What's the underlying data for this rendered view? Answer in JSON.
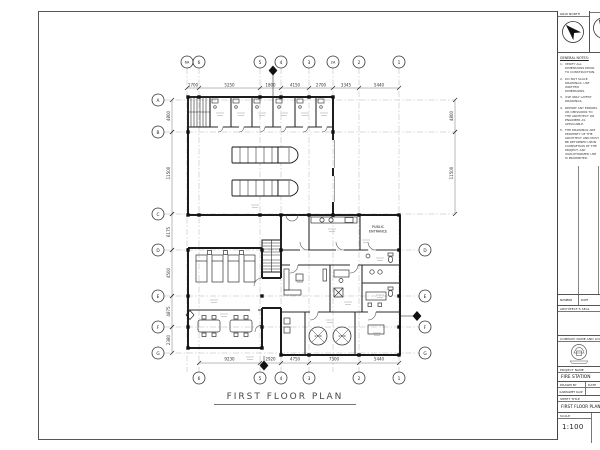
{
  "drawing": {
    "title": "FIRST FLOOR PLAN"
  },
  "plan": {
    "bubbles_top": [
      {
        "t": "6A",
        "x": 187
      },
      {
        "t": "6",
        "x": 199
      },
      {
        "t": "5",
        "x": 260
      },
      {
        "t": "4",
        "x": 281
      },
      {
        "t": "3",
        "x": 309
      },
      {
        "t": "2A",
        "x": 333
      },
      {
        "t": "2",
        "x": 359
      },
      {
        "t": "1",
        "x": 399
      }
    ],
    "bubbles_bottom": [
      {
        "t": "6",
        "x": 199
      },
      {
        "t": "5",
        "x": 260
      },
      {
        "t": "4",
        "x": 281
      },
      {
        "t": "3",
        "x": 309
      },
      {
        "t": "2",
        "x": 359
      },
      {
        "t": "1",
        "x": 399
      }
    ],
    "bubbles_left": [
      {
        "t": "A",
        "y": 100,
        "x2": 455
      },
      {
        "t": "B",
        "y": 132,
        "x2": 455
      },
      {
        "t": "C",
        "y": 214,
        "x2": 455
      },
      {
        "t": "D",
        "y": 250,
        "x2": 419
      },
      {
        "t": "E",
        "y": 296,
        "x2": 419
      },
      {
        "t": "F",
        "y": 327,
        "x2": 419
      },
      {
        "t": "G",
        "y": 353,
        "x2": 419
      }
    ],
    "bubbles_right": [
      {
        "t": "D",
        "y": 250
      },
      {
        "t": "E",
        "y": 296
      },
      {
        "t": "F",
        "y": 327
      },
      {
        "t": "G",
        "y": 353
      }
    ],
    "dims_top": [
      {
        "t": "1700",
        "x1": 187,
        "x2": 199
      },
      {
        "t": "5250",
        "x1": 199,
        "x2": 260
      },
      {
        "t": "1800",
        "x1": 260,
        "x2": 281
      },
      {
        "t": "4150",
        "x1": 281,
        "x2": 309
      },
      {
        "t": "2700",
        "x1": 309,
        "x2": 333
      },
      {
        "t": "3345",
        "x1": 333,
        "x2": 359
      },
      {
        "t": "5440",
        "x1": 359,
        "x2": 399
      }
    ],
    "dims_bottom": [
      {
        "t": "9230",
        "x1": 199,
        "x2": 260
      },
      {
        "t": "2920",
        "x1": 260,
        "x2": 281
      },
      {
        "t": "4750",
        "x1": 281,
        "x2": 309
      },
      {
        "t": "7300",
        "x1": 309,
        "x2": 359
      },
      {
        "t": "5440",
        "x1": 359,
        "x2": 399
      }
    ],
    "dims_left": [
      {
        "t": "4800",
        "y1": 100,
        "y2": 132
      },
      {
        "t": "11500",
        "y1": 132,
        "y2": 214
      },
      {
        "t": "6175",
        "y1": 214,
        "y2": 250
      },
      {
        "t": "4500",
        "y1": 250,
        "y2": 296
      },
      {
        "t": "4875",
        "y1": 296,
        "y2": 327
      },
      {
        "t": "2380",
        "y1": 327,
        "y2": 353
      }
    ],
    "dims_right": [
      {
        "t": "4800",
        "y1": 100,
        "y2": 132
      },
      {
        "t": "11500",
        "y1": 132,
        "y2": 214
      }
    ],
    "labels": [
      {
        "t": "PUBLIC",
        "x": 378,
        "y": 228
      },
      {
        "t": "ENTRANCE",
        "x": 378,
        "y": 232.5
      }
    ],
    "tanks": [
      {
        "t": "1700",
        "x": 318,
        "y": 337
      },
      {
        "t": "1700",
        "x": 342,
        "y": 337
      }
    ]
  },
  "titleblock": {
    "north": {
      "grid_label": "GRID NORTH"
    },
    "notes_title": "GENERAL NOTES:",
    "notes": [
      {
        "n": "1.",
        "text": "VERIFY ALL DIMENSIONS PRIOR TO CONSTRUCTION."
      },
      {
        "n": "2.",
        "text": "DO NOT SCALE DRAWINGS, USE WRITTEN DIMENSIONS."
      },
      {
        "n": "3.",
        "text": "USE ONLY LATEST DRAWINGS."
      },
      {
        "n": "4.",
        "text": "REPORT ANY ERRORS OR OMISSIONS TO THE ARCHITECT OR ENGINEER AS APPLICABLE."
      },
      {
        "n": "5.",
        "text": "THE DRAWINGS ARE PROPERTY OF THE ARCHITECT AND MUST BE RETURNED UPON COMPLETION OF THE PROJECT. ANY UNAUTHORIZED USE IS PROHIBITED."
      }
    ],
    "revision": {
      "number_label": "NUMBER",
      "date_label": "DATE"
    },
    "seal_label": "ARCHITECT'S SEAL",
    "company_label": "COMPANY NAME AND LOGO",
    "project_label": "PROJECT NAME",
    "project_value": "FIRE STATION",
    "drawn_by_label": "DRAWN BY",
    "drawn_by_value": "KARPAWET KAIP",
    "date_label": "DATE",
    "sheet_title_label": "SHEET TITLE",
    "sheet_title_value": "FIRST FLOOR PLAN",
    "scale_label": "SCALE",
    "scale_value": "1:100"
  }
}
